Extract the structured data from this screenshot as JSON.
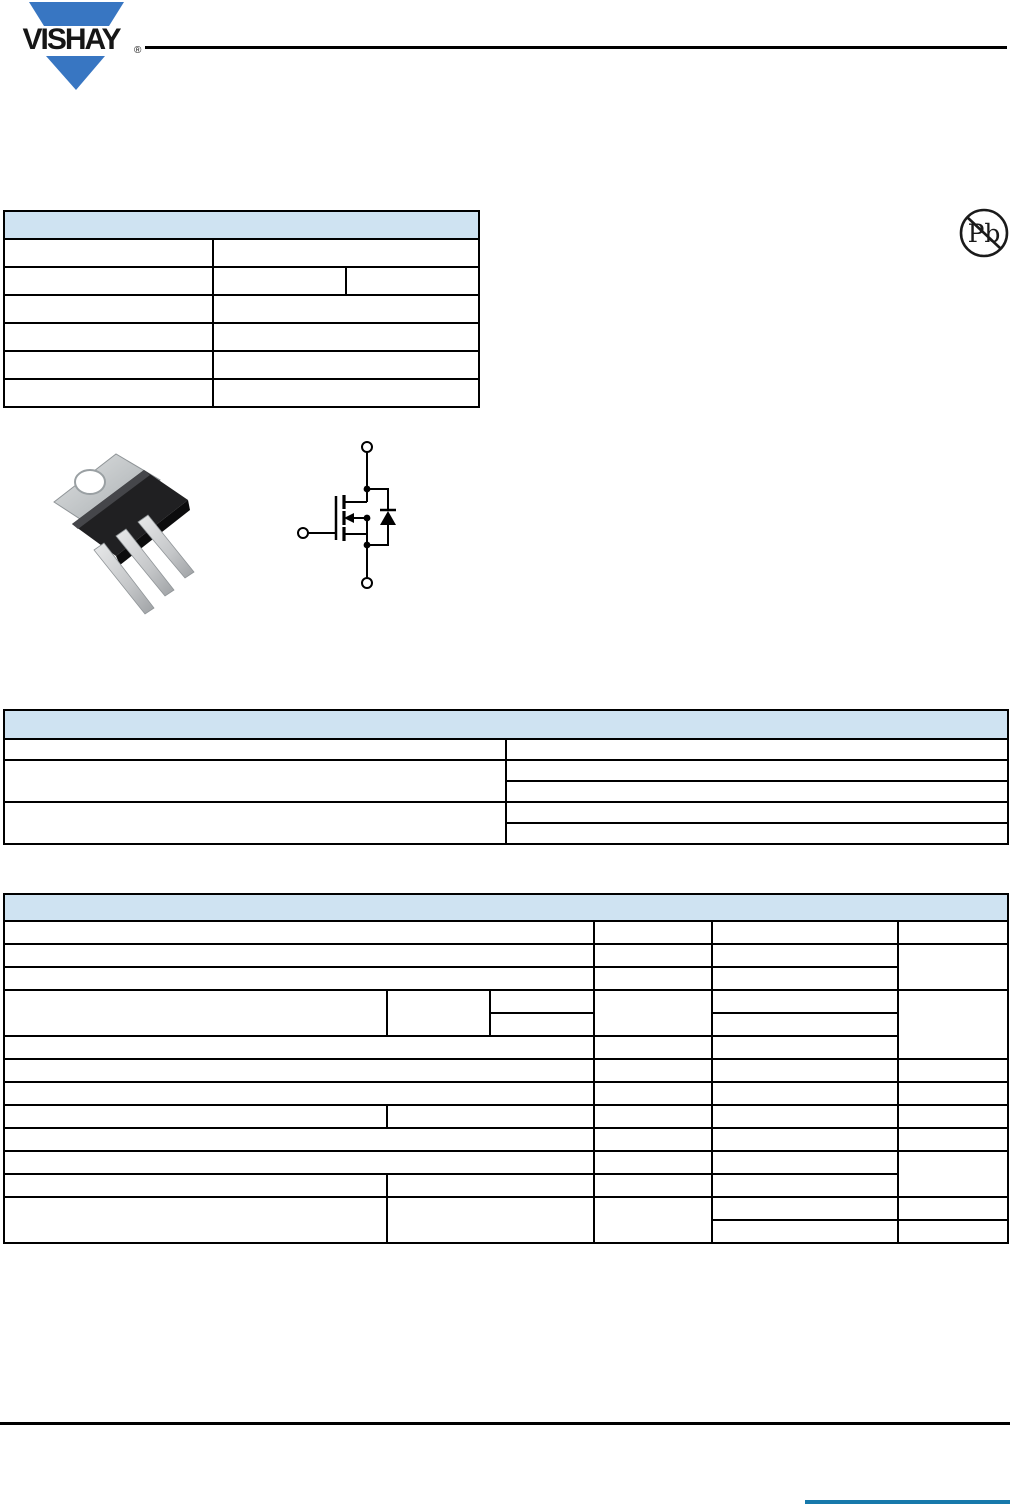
{
  "brand": {
    "name": "VISHAY",
    "registered_mark": "®",
    "logo_color": "#3876c2"
  },
  "pb_free_badge": {
    "text": "Pb"
  },
  "colors": {
    "table_header_fill": "#cfe3f2",
    "table_border": "#000000",
    "header_rule": "#000000",
    "footer_rule": "#000000",
    "footer_accent_blue": "#1779ab",
    "package_body": "#1c1c1e",
    "package_metal": "#c7cacc"
  },
  "tables": {
    "product_summary": {
      "header_label": "",
      "body_rows": 6
    },
    "ordering_information": {
      "header_label": "",
      "body_rows": 5
    },
    "absolute_maximum_ratings": {
      "header_label": "",
      "body_rows": 14
    }
  }
}
